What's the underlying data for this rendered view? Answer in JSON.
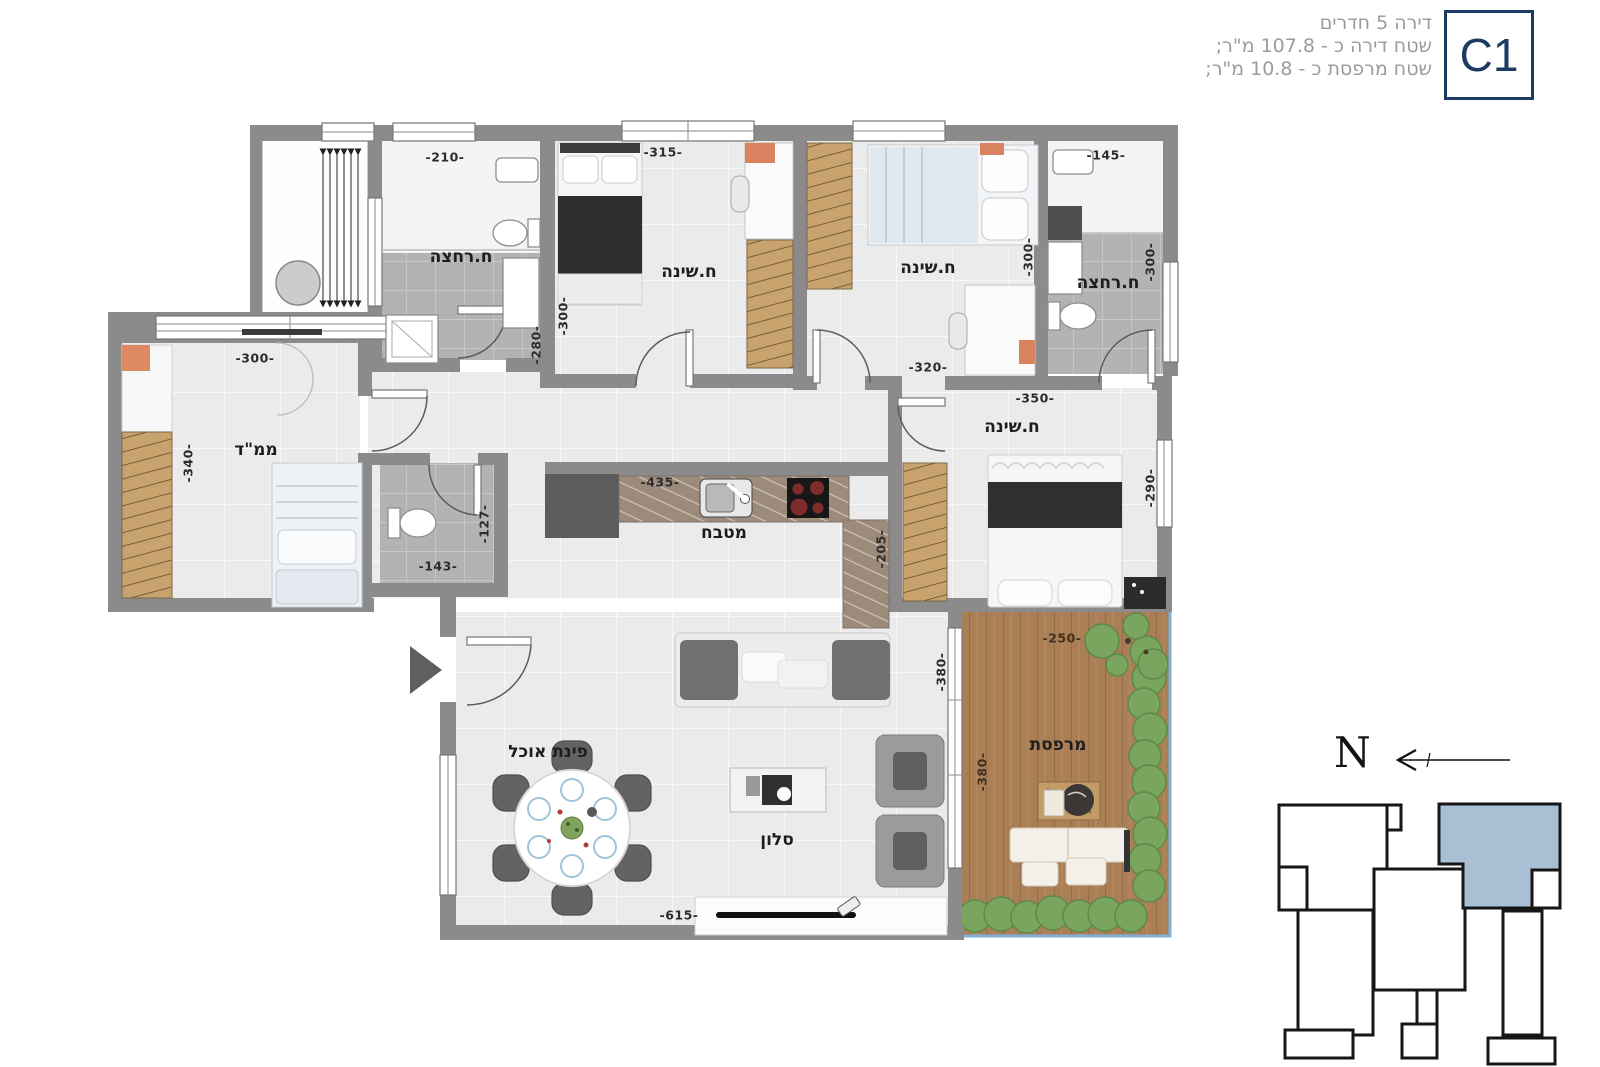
{
  "header": {
    "title": "דירה 5 חדרים",
    "area_line": "שטח דירה כ - 107.8 מ\"ר;",
    "balcony_line": "שטח מרפסת כ - 10.8 מ\"ר;",
    "unit_label": "C1"
  },
  "rooms": {
    "bathroom": "ח.רחצה",
    "bedroom": "ח.שינה",
    "safe_room": "ממ\"ד",
    "kitchen": "מטבח",
    "dining": "פינת אוכל",
    "living": "סלון",
    "balcony": "מרפסת"
  },
  "dimensions": {
    "d210": "-210-",
    "d315": "-315-",
    "d145": "-145-",
    "d300": "-300-",
    "d280": "-280-",
    "d320": "-320-",
    "d350": "-350-",
    "d340": "-340-",
    "d143": "-143-",
    "d127": "-127-",
    "d435": "-435-",
    "d205": "-205-",
    "d290": "-290-",
    "d380": "-380-",
    "d250": "-250-",
    "d615": "-615-"
  },
  "compass": {
    "north_label": "N"
  },
  "colors": {
    "wall_gray": "#8b8b8b",
    "navy": "#1e3b63",
    "key_plan_highlight": "#a9bfd3",
    "deck_brown": "#aa7f56",
    "hedge_green": "#7aa55f"
  }
}
